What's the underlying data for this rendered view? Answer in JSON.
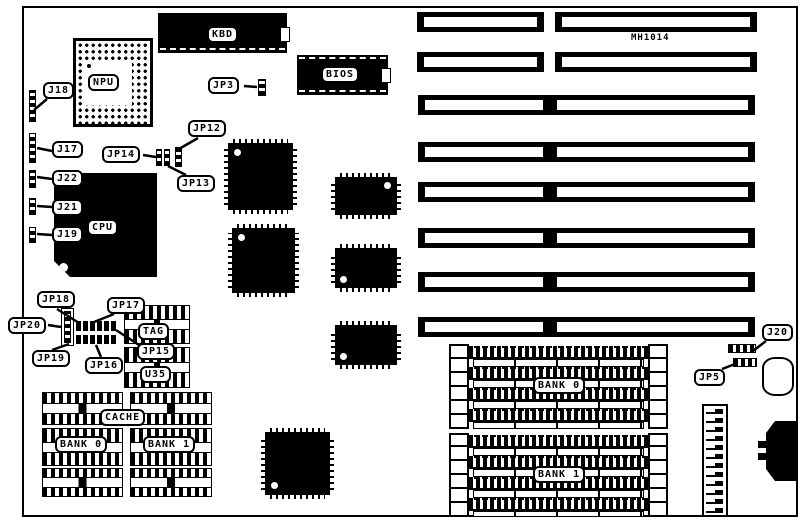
{
  "board": {
    "id": "MH1014"
  },
  "chips": {
    "npu": {
      "label": "NPU"
    },
    "cpu": {
      "label": "CPU"
    },
    "kbd": {
      "label": "KBD"
    },
    "bios": {
      "label": "BIOS"
    },
    "tag": {
      "label": "TAG"
    },
    "u35": {
      "label": "U35"
    }
  },
  "jumpers": {
    "j18": "J18",
    "j17": "J17",
    "j22": "J22",
    "j21": "J21",
    "j19": "J19",
    "jp3": "JP3",
    "jp12": "JP12",
    "jp13": "JP13",
    "jp14": "JP14",
    "jp15": "JP15",
    "jp16": "JP16",
    "jp17": "JP17",
    "jp18": "JP18",
    "jp19": "JP19",
    "jp20": "JP20",
    "j20": "J20",
    "jp5": "JP5"
  },
  "cache": {
    "label": "CACHE",
    "bank0": "BANK 0",
    "bank1": "BANK 1"
  },
  "memory": {
    "bank0": "BANK 0",
    "bank1": "BANK 1"
  },
  "counts": {
    "isa_slots": 8,
    "simm_sockets_per_bank": 4,
    "cache_chips_per_bank": 3
  },
  "colors": {
    "ink": "#000000",
    "paper": "#ffffff"
  }
}
